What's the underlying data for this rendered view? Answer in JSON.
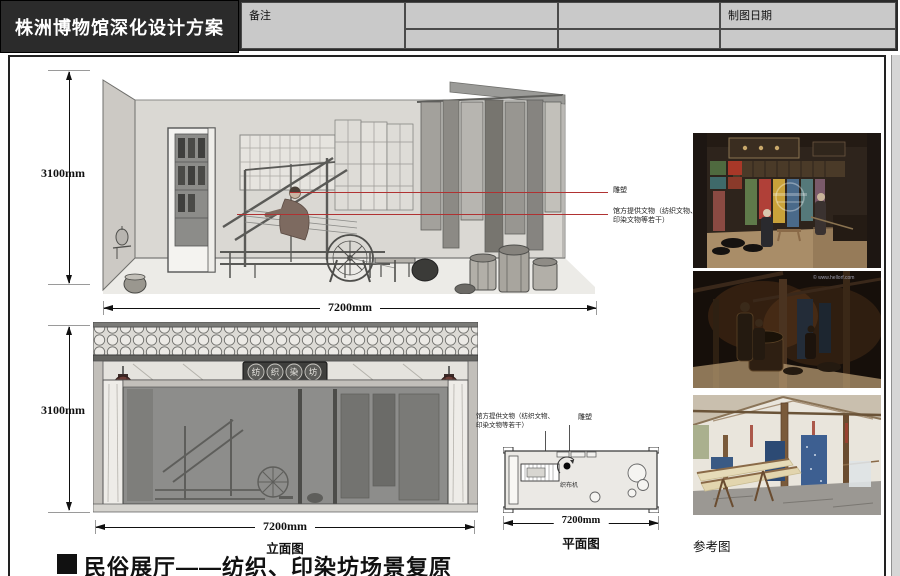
{
  "header": {
    "title": "株洲博物馆深化设计方案",
    "cells": {
      "drawing_date": "制图日期",
      "remarks": "备注"
    }
  },
  "elevation_top": {
    "height_label": "3100mm",
    "width_label": "7200mm",
    "ann_sculpture": "雕塑",
    "ann_artifacts_1": "馆方提供文物（纺织文物、",
    "ann_artifacts_2": "印染文物等若干）"
  },
  "elevation_front": {
    "height_label": "3100mm",
    "width_label": "7200mm",
    "caption": "立面图",
    "sign": [
      "纺",
      "织",
      "染",
      "坊"
    ]
  },
  "plan": {
    "width_label": "7200mm",
    "caption": "平面图",
    "ann_artifacts_1": "馆方提供文物（纺织文物、",
    "ann_artifacts_2": "印染文物等若干）",
    "ann_sculpture": "雕塑",
    "room_label": "织布机"
  },
  "reference": {
    "caption": "参考图",
    "watermark": "© www.hellorf.com"
  },
  "footer": {
    "bullet": "■",
    "section_title": "民俗展厅——纺织、印染坊场景复原"
  },
  "colors": {
    "annotation_red": "#b03232",
    "header_bg": "#2b2b2b",
    "table_bg": "#c9c9c9"
  }
}
